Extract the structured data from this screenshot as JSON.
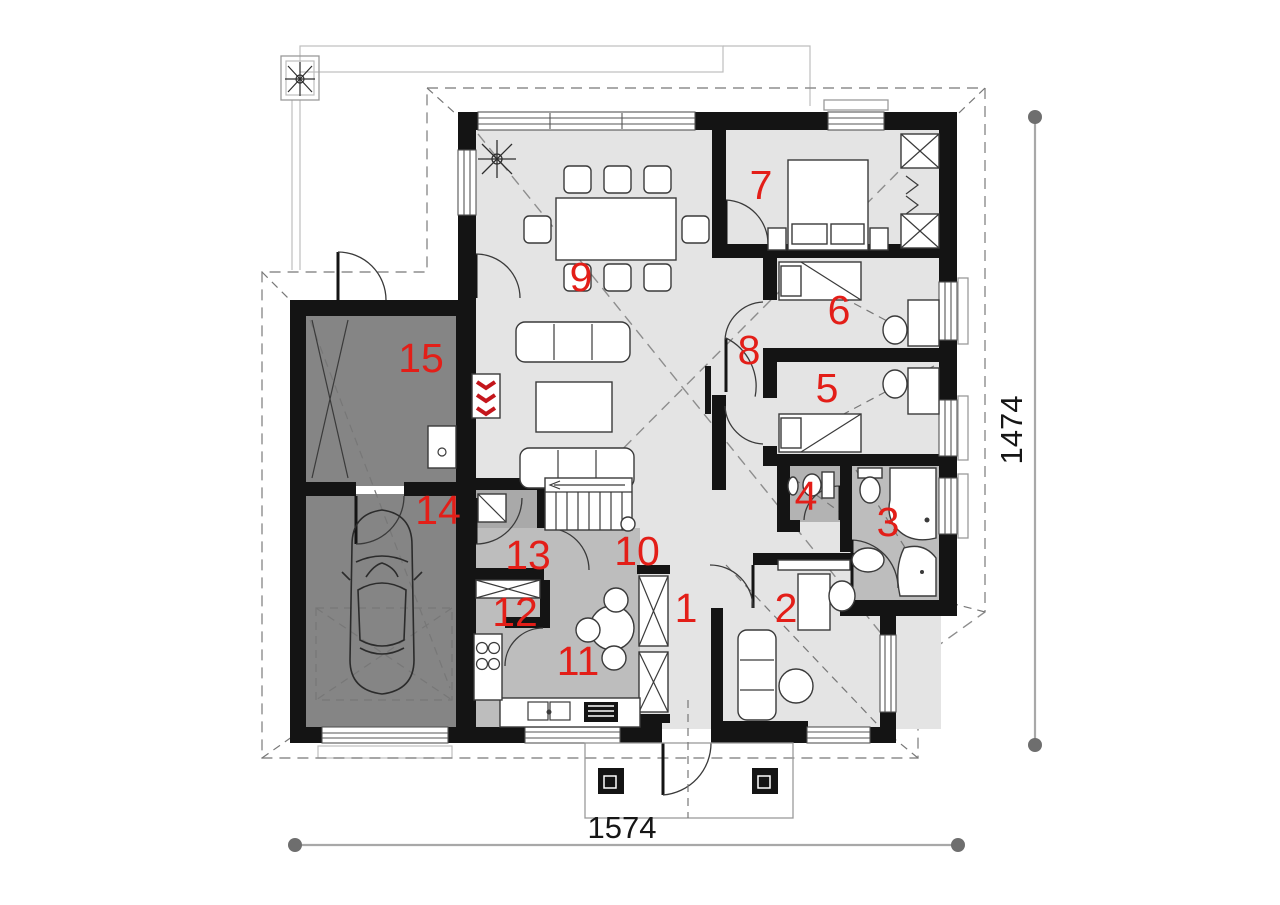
{
  "plan": {
    "title": "single-storey house floor plan with garage",
    "rooms": [
      {
        "number": "1"
      },
      {
        "number": "2"
      },
      {
        "number": "3"
      },
      {
        "number": "4"
      },
      {
        "number": "5"
      },
      {
        "number": "6"
      },
      {
        "number": "7"
      },
      {
        "number": "8"
      },
      {
        "number": "9"
      },
      {
        "number": "10"
      },
      {
        "number": "11"
      },
      {
        "number": "12"
      },
      {
        "number": "13"
      },
      {
        "number": "14"
      },
      {
        "number": "15"
      }
    ],
    "dimensions": {
      "width": "1574",
      "height": "1474"
    },
    "colors": {
      "wall": "#141414",
      "room_light": "#e4e4e4",
      "room_medium": "#bdbdbd",
      "room_dark": "#a9a9a9",
      "wc_floor": "#b3b3b3",
      "garage_floor": "#858585",
      "label_red": "#e31e18",
      "dashed_gray": "#8d8d8d",
      "dimension_gray": "#6e6e6e",
      "fireplace_red": "#c4161c"
    }
  }
}
